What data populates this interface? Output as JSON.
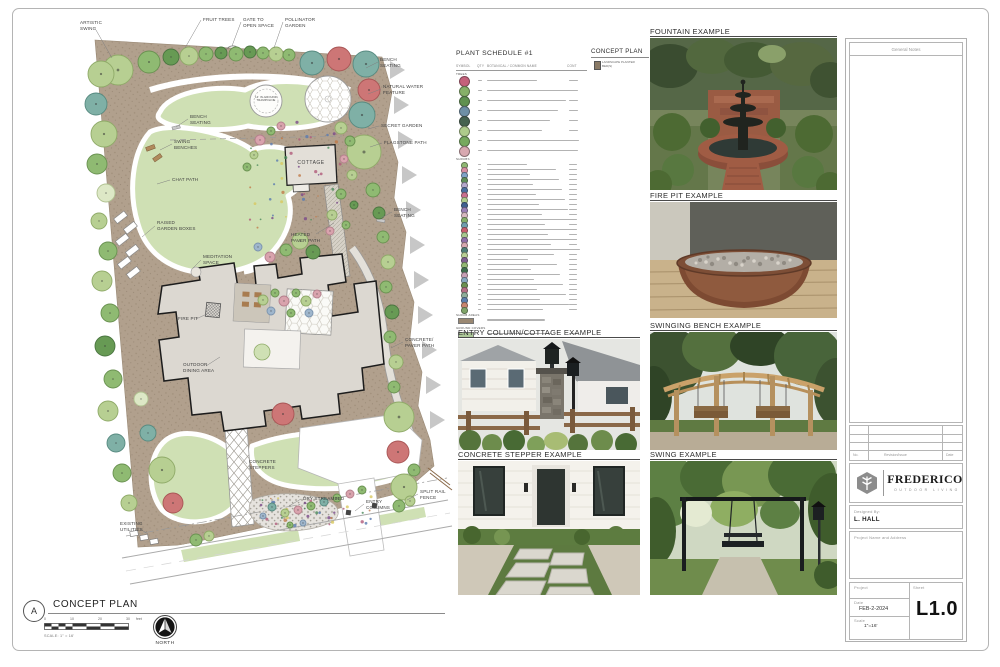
{
  "plan": {
    "annotations": [
      "ARTISTIC\nSWING",
      "FRUIT TREES",
      "GATE TO\nOPEN SPACE",
      "POLLINATOR\nGARDEN",
      "BENCH\nSEATING",
      "NATURAL WATER\nFEATURE",
      "SECRET GARDEN",
      "FLAGSTONE PATH",
      "BENCH\nSEATING",
      "SWING\nBENCHES",
      "CHAT PATH",
      "RAISED\nGARDEN BOXES",
      "MEDITATION\nSPACE",
      "BENCH\nSEATING",
      "HEATED\nPAVER PATH",
      "FIRE PIT",
      "OUTDOOR\nDINING AREA",
      "CONCRETE/\nPAVER PATH",
      "CONCRETE\nSTEPPERS",
      "DRY STREAMBED",
      "ENTRY\nCOLUMNS",
      "SPLIT RAIL\nFENCE",
      "EXISTING\nUTILITIES"
    ],
    "trampoline_label": "14' IN-GROUND\nTRAMPOLINE",
    "cottage_label": "COTTAGE"
  },
  "plant_schedule": {
    "title": "PLANT SCHEDULE #1",
    "columns": [
      "SYMBOL",
      "QTY",
      "BOTANICAL / COMMON NAME",
      "CONT"
    ],
    "groups": [
      "TREES",
      "SHRUBS",
      "SHRUB AREAS",
      "GROUND COVERS"
    ],
    "tree_row_colors": [
      "#c4607a",
      "#86b068",
      "#5f9150",
      "#6e8fa6",
      "#45624f",
      "#aecb8b",
      "#77a95e",
      "#d8a8b0"
    ],
    "small_row_colors": [
      "#8fb873",
      "#d78fa3",
      "#7fa3c9",
      "#5f8f5a",
      "#b5a8cc",
      "#4a6fa0",
      "#c96f8f",
      "#aecb8b",
      "#3f5f8f",
      "#9a7fb5",
      "#d7b8c0",
      "#86b06a",
      "#6f9fae",
      "#c95f6f",
      "#a8c98f",
      "#8f6fa8",
      "#d8a8b0",
      "#4f7f78",
      "#b9d194",
      "#7f5f8f",
      "#93b873",
      "#3f6f4f",
      "#c9a0b5",
      "#86a8c0",
      "#6a9150",
      "#b56f86",
      "#8fae9a",
      "#5b7fae",
      "#c9856f",
      "#7fa468"
    ],
    "swatch_colors": {
      "shrub_areas": "#9a8872",
      "ground_covers": "#aec89a"
    }
  },
  "legend": {
    "title": "CONCEPT PLAN",
    "item": "LANDSCAPE PLANTER\nBED(S)"
  },
  "photos": [
    {
      "label": "FOUNTAIN EXAMPLE"
    },
    {
      "label": "FIRE PIT EXAMPLE"
    },
    {
      "label": "ENTRY COLUMN/COTTAGE EXAMPLE"
    },
    {
      "label": "SWINGING BENCH EXAMPLE"
    },
    {
      "label": "CONCRETE STEPPER EXAMPLE"
    },
    {
      "label": "SWING EXAMPLE"
    }
  ],
  "titleblock": {
    "general_notes": "General Notes",
    "revision_headers": [
      "No.",
      "Revision/Issue",
      "Date"
    ],
    "brand": "FREDERICO",
    "brand_sub": "OUTDOOR LIVING",
    "designed_by_label": "Designed By:",
    "designer": "L. HALL",
    "project_name_label": "Project Name and Address",
    "project_label": "Project",
    "sheet_label": "Sheet",
    "date_label": "Date",
    "date_value": "FEB-2-2024",
    "scale_label": "Scale",
    "scale_value": "1\"=16'",
    "sheet_number": "L1.0"
  },
  "footer": {
    "detail_letter": "A",
    "title": "CONCEPT PLAN",
    "scale_ticks": [
      "0",
      "10",
      "20",
      "30"
    ],
    "scale_unit": "feet",
    "scale_note": "SCALE: 1\" = 16'",
    "north_label": "NORTH"
  }
}
